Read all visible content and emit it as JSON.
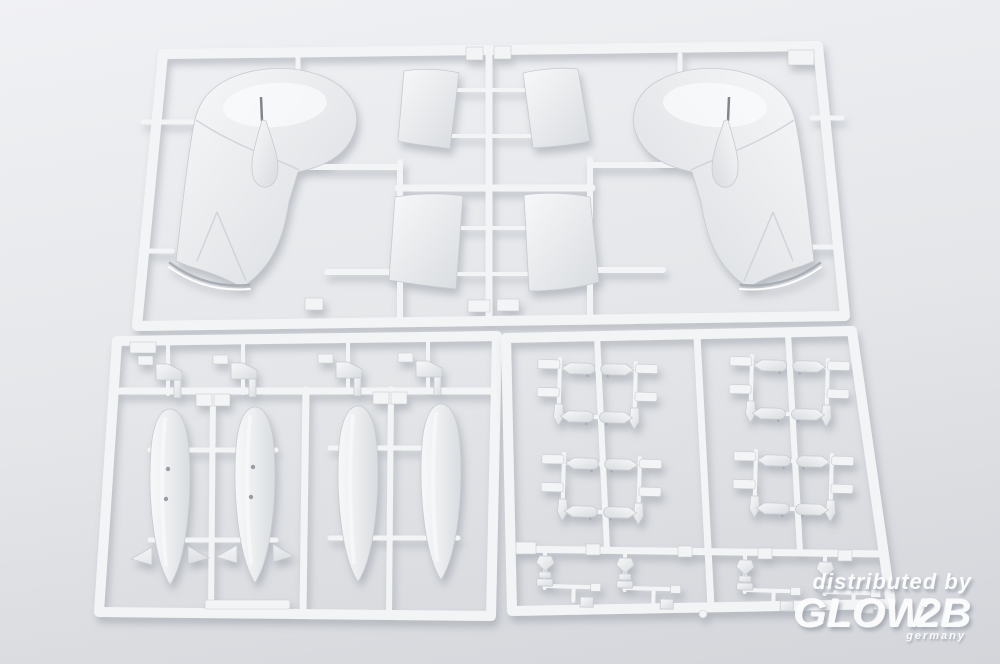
{
  "scene": {
    "description": "Product photo of three white polystyrene model kit sprues (injection-molded runner frames) holding aircraft parts: two mirrored wingtip-float/cowling halves, four tailplane panels, four drop-tank/bomb halves (two with tail fins), clusters of small bombs with mounting brackets, and small fittings, lying on a light grey surface."
  },
  "watermark": {
    "line1": "distributed by",
    "brand_glow": "GLOW",
    "brand_2b": "2B",
    "country": "germany"
  },
  "colors": {
    "bg_top": "#f0f1f4",
    "bg_mid": "#e4e6e9",
    "bg_bottom": "#d3d5da",
    "plastic": "#f3f4f6",
    "edge": "#c7cbd0",
    "part_light": "#f7f8f9",
    "part_dark": "#d9dce0",
    "hole": "#979da5",
    "wm": "#fdfdfe",
    "wm_sh": "#9fa5ae"
  }
}
